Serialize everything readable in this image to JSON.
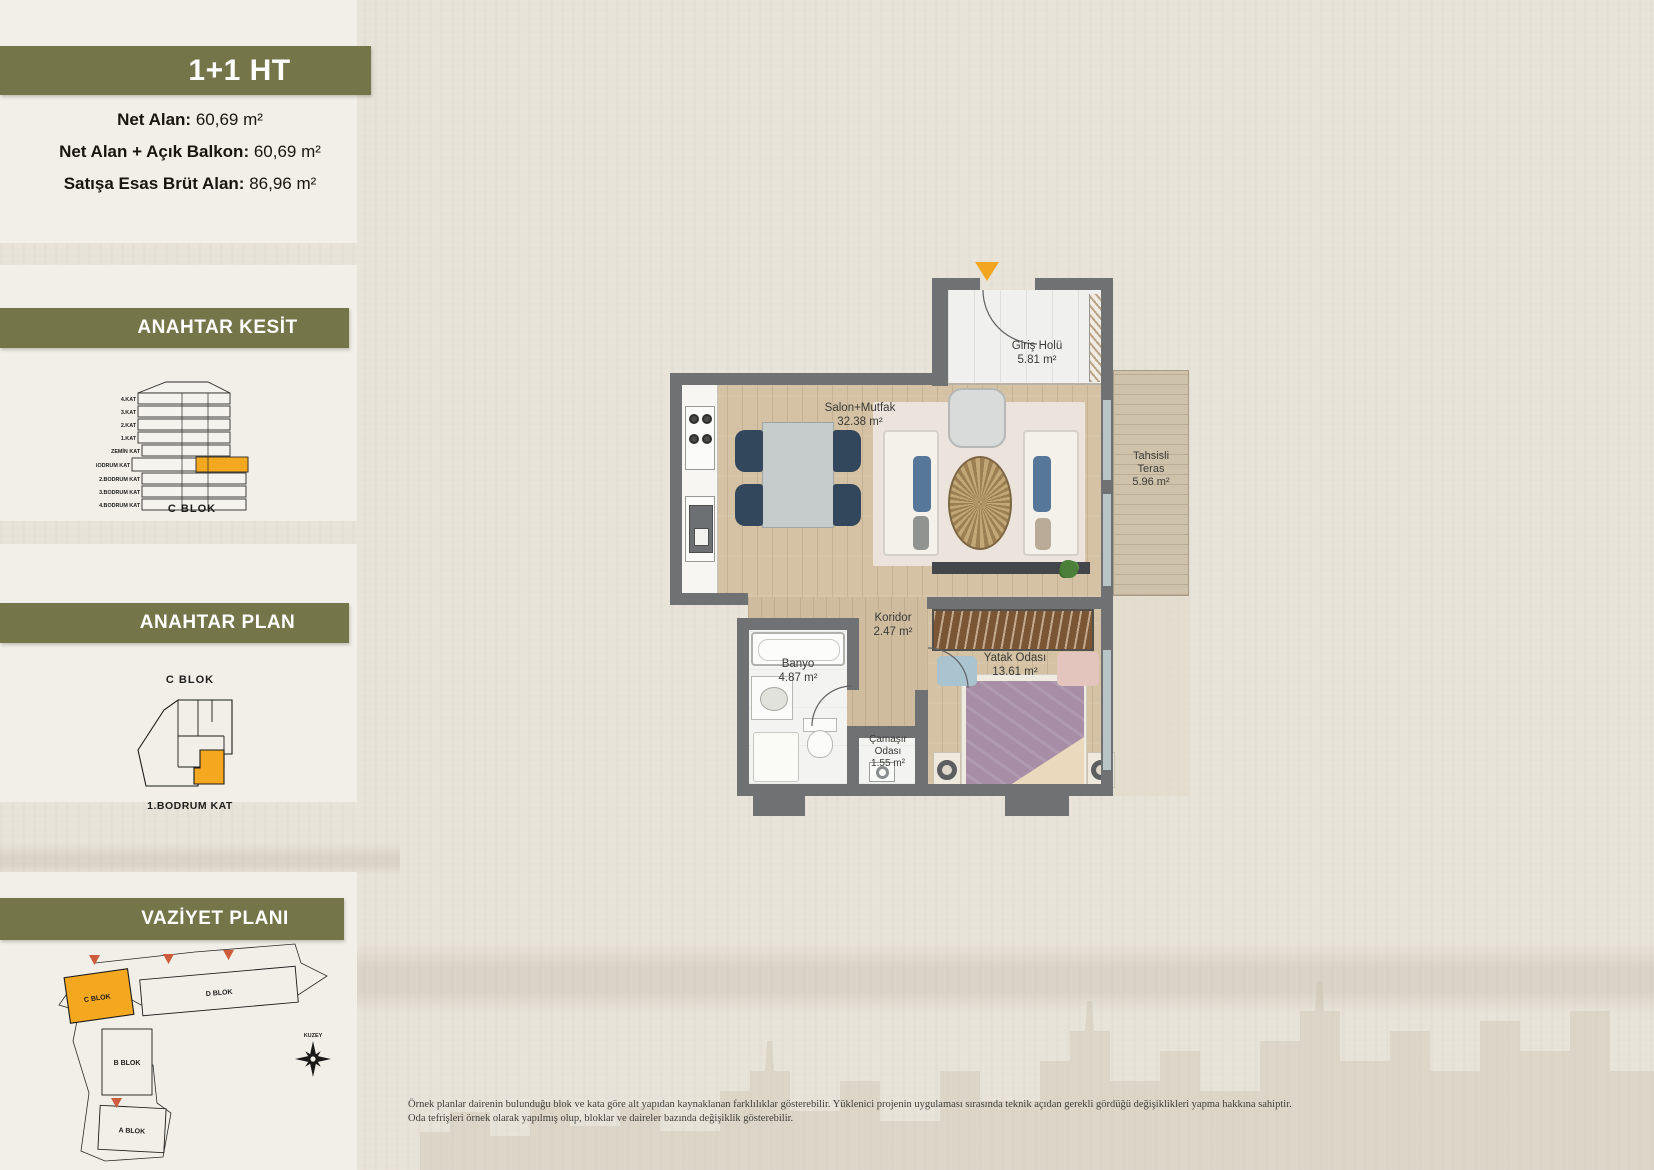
{
  "unit": {
    "title": "1+1 HT",
    "areas": [
      {
        "label": "Net Alan:",
        "value": "60,69 m²"
      },
      {
        "label": "Net Alan + Açık Balkon:",
        "value": "60,69 m²"
      },
      {
        "label": "Satışa Esas Brüt Alan:",
        "value": "86,96 m²"
      }
    ]
  },
  "kesit": {
    "title": "ANAHTAR KESİT",
    "block": "C BLOK",
    "floors": [
      "4.KAT",
      "3.KAT",
      "2.KAT",
      "1.KAT",
      "ZEMİN KAT",
      "1.BODRUM KAT",
      "2.BODRUM KAT",
      "3.BODRUM KAT",
      "4.BODRUM KAT"
    ],
    "highlighted_floor": "1.BODRUM KAT"
  },
  "anahtar_plan": {
    "title": "ANAHTAR PLAN",
    "block": "C BLOK",
    "floor": "1.BODRUM KAT"
  },
  "vaziyet": {
    "title": "VAZİYET PLANI",
    "compass": "KUZEY",
    "blocks": {
      "a": "A BLOK",
      "b": "B BLOK",
      "c": "C BLOK",
      "d": "D BLOK"
    },
    "highlighted_block": "C BLOK"
  },
  "floorplan": {
    "rooms": [
      {
        "name": "Giriş Holü",
        "area": "5.81 m²"
      },
      {
        "name": "Salon+Mutfak",
        "area": "32.38 m²"
      },
      {
        "name": "Tahsisli Teras",
        "area": "5.96 m²"
      },
      {
        "name": "Koridor",
        "area": "2.47 m²"
      },
      {
        "name": "Banyo",
        "area": "4.87 m²"
      },
      {
        "name": "Çamaşır Odası",
        "area": "1.55 m²"
      },
      {
        "name": "Yatak Odası",
        "area": "13.61 m²"
      }
    ]
  },
  "disclaimer": {
    "line1": "Örnek planlar dairenin bulunduğu blok ve kata göre alt yapıdan kaynaklanan farklılıklar gösterebilir. Yüklenici projenin uygulaması sırasında teknik açıdan gerekli gördüğü değişiklikleri yapma hakkına sahiptir.",
    "line2": "Oda tefrişleri örnek olarak yapılmış olup, bloklar ve daireler bazında değişiklik gösterebilir."
  },
  "colors": {
    "olive": "#747549",
    "orange": "#f3a81f",
    "arrow_red": "#cf5b3d",
    "wall_gray": "#6f7173"
  }
}
